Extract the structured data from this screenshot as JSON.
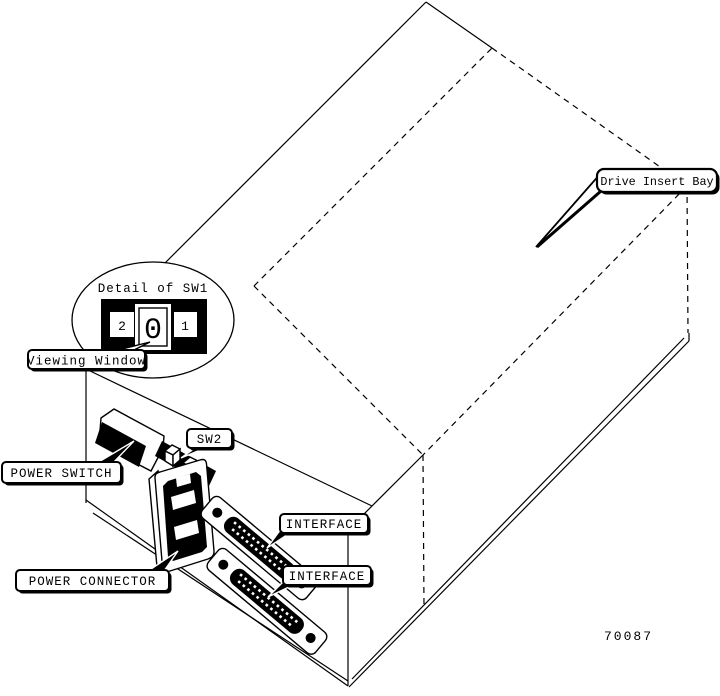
{
  "figure": {
    "number": "70087"
  },
  "callouts": {
    "drive_insert_bay": {
      "label": "Drive Insert Bay"
    },
    "viewing_window": {
      "label": "Viewing Window"
    },
    "power_switch": {
      "label": "POWER SWITCH"
    },
    "sw2": {
      "label": "SW2"
    },
    "power_connector": {
      "label": "POWER CONNECTOR"
    },
    "interface_top": {
      "label": "INTERFACE"
    },
    "interface_bottom": {
      "label": "INTERFACE"
    }
  },
  "detail_sw1": {
    "title": "Detail of SW1",
    "positions": {
      "left": "2",
      "center": "0",
      "right": "1"
    }
  },
  "colors": {
    "line": "#000000",
    "background": "#ffffff"
  }
}
